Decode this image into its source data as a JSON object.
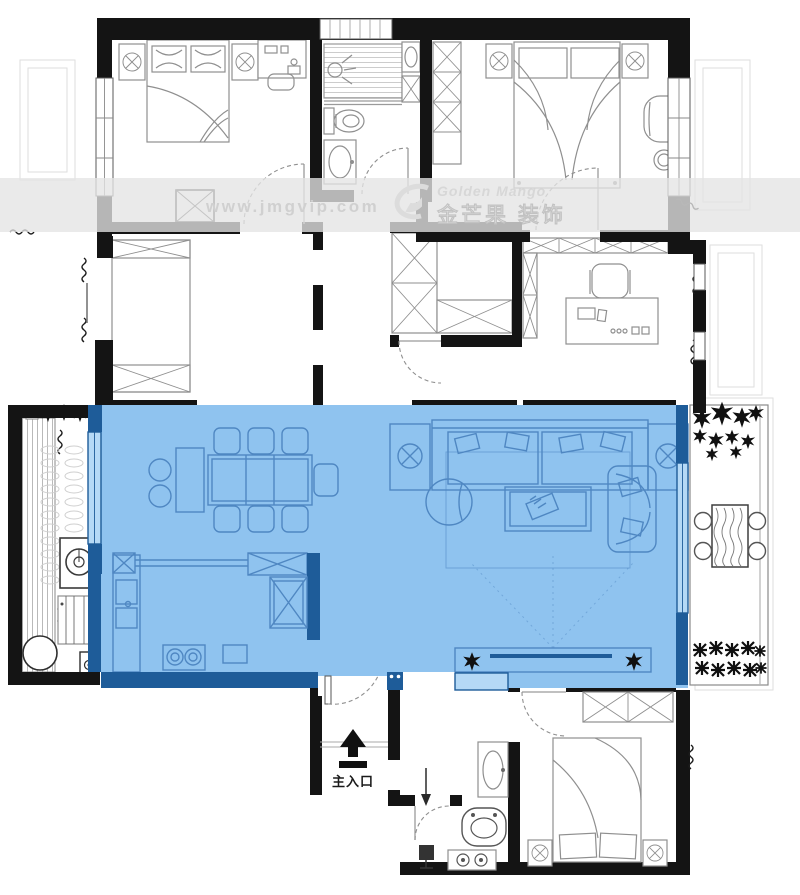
{
  "watermark": {
    "website": "www.jmgvip.com",
    "brand_en": "Golden Mango",
    "brand_cn": "金芒果 装饰",
    "logo_icon": "golden-mango-logo"
  },
  "entrance": {
    "label": "主入口",
    "icon": "arrow-up-icon"
  },
  "colors": {
    "paper": "#ffffff",
    "wall": "#141414",
    "line": "#8f8f8f",
    "line_light": "#dedede",
    "highlight": "#8fc3ef",
    "highlight_wall": "#1e5c99",
    "highlight_line": "#4f87c2",
    "highlight_window": "#b5d9f6",
    "watermark_text": "#d0d0d0"
  }
}
